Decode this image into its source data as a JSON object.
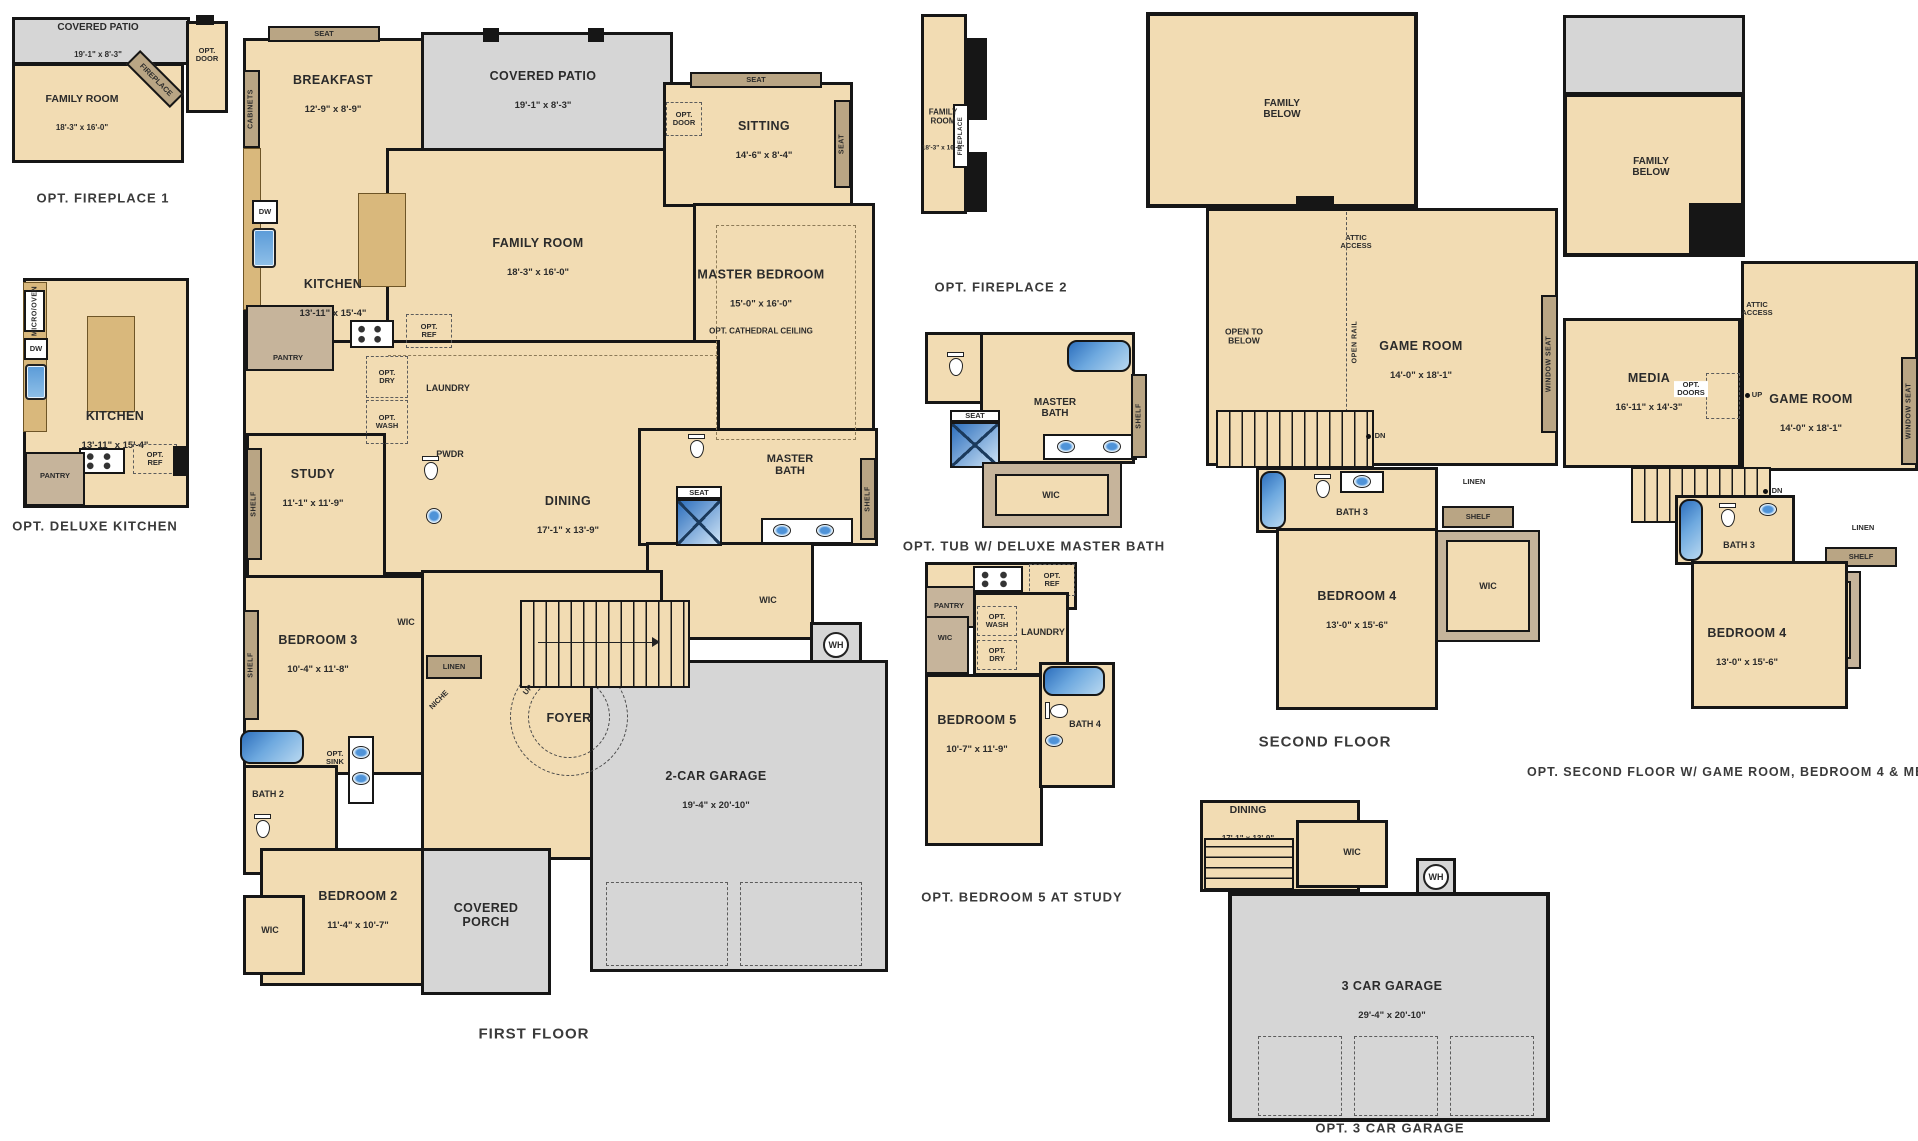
{
  "palette": {
    "room_fill": "#f2dcb3",
    "paved_fill": "#d6d6d6",
    "wall": "#161616",
    "seat_fill": "#b9a584",
    "counter_fill": "#d9b87c",
    "closet_fill": "#c6b49b",
    "fixture_blue": "#2d6fbd",
    "text": "#2b2b2b"
  },
  "captions": {
    "opt_fireplace1": "OPT. FIREPLACE 1",
    "opt_deluxe_kitchen": "OPT. DELUXE KITCHEN",
    "first_floor": "FIRST FLOOR",
    "opt_fireplace2": "OPT. FIREPLACE 2",
    "opt_tub": "OPT. TUB W/ DELUXE MASTER BATH",
    "opt_bedroom5": "OPT. BEDROOM 5 AT STUDY",
    "second_floor": "SECOND FLOOR",
    "opt_second_floor": "OPT. SECOND FLOOR W/ GAME ROOM, BEDROOM 4 & MEDIA",
    "opt_3car_garage": "OPT. 3 CAR GARAGE"
  },
  "opt_fireplace1": {
    "covered_patio": {
      "name": "COVERED PATIO",
      "dims": "19'-1\" x 8'-3\""
    },
    "family_room": {
      "name": "FAMILY ROOM",
      "dims": "18'-3\" x 16'-0\""
    },
    "fireplace": "FIREPLACE",
    "opt_door": "OPT. DOOR"
  },
  "opt_deluxe_kitchen": {
    "kitchen": {
      "name": "KITCHEN",
      "dims": "13'-11\" x 15'-4\""
    },
    "micro_oven": "MICRO/OVEN",
    "dw": "DW",
    "pantry": "PANTRY",
    "opt_ref": "OPT. REF"
  },
  "first_floor": {
    "breakfast": {
      "name": "BREAKFAST",
      "dims": "12'-9\" x 8'-9\""
    },
    "covered_patio": {
      "name": "COVERED PATIO",
      "dims": "19'-1\" x 8'-3\""
    },
    "sitting": {
      "name": "SITTING",
      "dims": "14'-6\" x 8'-4\""
    },
    "family_room": {
      "name": "FAMILY ROOM",
      "dims": "18'-3\" x 16'-0\""
    },
    "master_bedroom": {
      "name": "MASTER BEDROOM",
      "dims": "15'-0\" x 16'-0\"",
      "note": "OPT. CATHEDRAL CEILING"
    },
    "kitchen": {
      "name": "KITCHEN",
      "dims": "13'-11\" x 15'-4\""
    },
    "study": {
      "name": "STUDY",
      "dims": "11'-1\" x 11'-9\""
    },
    "dining": {
      "name": "DINING",
      "dims": "17'-1\" x 13'-9\""
    },
    "master_bath": "MASTER BATH",
    "bedroom3": {
      "name": "BEDROOM 3",
      "dims": "10'-4\" x 11'-8\""
    },
    "bedroom2": {
      "name": "BEDROOM 2",
      "dims": "11'-4\" x 10'-7\""
    },
    "bath2": "BATH 2",
    "garage": {
      "name": "2-CAR GARAGE",
      "dims": "19'-4\" x 20'-10\""
    },
    "covered_porch": "COVERED PORCH",
    "foyer": "FOYER",
    "laundry": "LAUNDRY",
    "pwdr": "PWDR",
    "pantry": "PANTRY",
    "wic": "WIC",
    "linen": "LINEN",
    "niche": "NICHE",
    "seat": "SEAT",
    "cabinets": "CABINETS",
    "shelf": "SHELF",
    "dw": "DW",
    "wh": "WH",
    "up": "UP",
    "opt_door": "OPT. DOOR",
    "opt_ref": "OPT. REF",
    "opt_dry": "OPT. DRY",
    "opt_wash": "OPT. WASH",
    "opt_sink": "OPT. SINK"
  },
  "opt_fireplace2": {
    "family_room": {
      "name": "FAMILY ROOM",
      "dims": "18'-3\" x 16'-0\""
    },
    "fireplace": "FIREPLACE"
  },
  "opt_tub": {
    "master_bath": "MASTER BATH",
    "seat": "SEAT",
    "wic": "WIC",
    "shelf": "SHELF"
  },
  "opt_bedroom5": {
    "bedroom5": {
      "name": "BEDROOM 5",
      "dims": "10'-7\" x 11'-9\""
    },
    "bath4": "BATH 4",
    "laundry": "LAUNDRY",
    "pantry": "PANTRY",
    "wic": "WIC",
    "opt_wash": "OPT. WASH",
    "opt_dry": "OPT. DRY",
    "opt_ref": "OPT. REF"
  },
  "second_floor": {
    "family_below": "FAMILY BELOW",
    "attic_access": "ATTIC ACCESS",
    "open_to_below": "OPEN TO BELOW",
    "open_rail": "OPEN RAIL",
    "game_room": {
      "name": "GAME ROOM",
      "dims": "14'-0\" x 18'-1\""
    },
    "window_seat": "WINDOW SEAT",
    "bedroom4": {
      "name": "BEDROOM 4",
      "dims": "13'-0\" x 15'-6\""
    },
    "bath3": "BATH 3",
    "wic": "WIC",
    "linen": "LINEN",
    "shelf": "SHELF",
    "dn": "DN"
  },
  "opt_second_floor": {
    "family_below": "FAMILY BELOW",
    "attic_access": "ATTIC ACCESS",
    "media": {
      "name": "MEDIA",
      "dims": "16'-11\" x 14'-3\""
    },
    "game_room": {
      "name": "GAME ROOM",
      "dims": "14'-0\" x 18'-1\""
    },
    "opt_doors": "OPT. DOORS",
    "up": "UP",
    "window_seat": "WINDOW SEAT",
    "bedroom4": {
      "name": "BEDROOM 4",
      "dims": "13'-0\" x 15'-6\""
    },
    "bath3": "BATH 3",
    "wic": "WIC",
    "linen": "LINEN",
    "shelf": "SHELF",
    "dn": "DN"
  },
  "opt_3car_garage": {
    "dining": {
      "name": "DINING",
      "dims": "17'-1\" x 13'-9\""
    },
    "garage": {
      "name": "3 CAR GARAGE",
      "dims": "29'-4\" x 20'-10\""
    },
    "wic": "WIC",
    "wh": "WH"
  }
}
